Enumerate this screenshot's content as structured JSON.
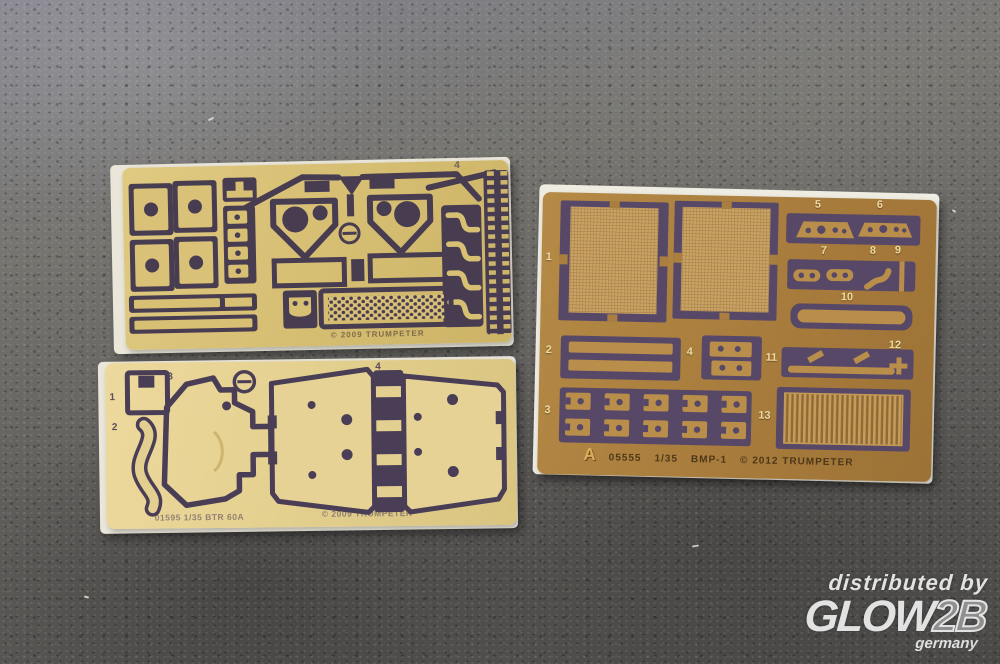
{
  "watermark": {
    "prefix": "distributed by",
    "brand_main": "GLOW",
    "brand_suffix": "2B",
    "country": "germany"
  },
  "sheets": {
    "top_left": {
      "part_labels": [
        "4"
      ],
      "footer_text": "© 2009 TRUMPETER"
    },
    "bottom_left": {
      "part_labels": [
        "1",
        "2",
        "3",
        "4"
      ],
      "footer_code": "01595 1/35 BTR 60A",
      "footer_copyright": "© 2009 TRUMPETER"
    },
    "right": {
      "part_labels": [
        "1",
        "2",
        "3",
        "4",
        "5",
        "6",
        "7",
        "8",
        "9",
        "10",
        "11",
        "12",
        "13"
      ],
      "footer": {
        "fret_letter": "A",
        "kit_number": "05555",
        "scale": "1/35",
        "kit_name": "BMP-1",
        "copyright": "© 2012 TRUMPETER"
      }
    }
  },
  "colors": {
    "carpet_gray": "#5e5d5a",
    "sheet_tan": "#d7bf74",
    "sheet_pale": "#e3cf90",
    "sheet_brown": "#a97e3e",
    "etch_dark": "#4a3e54",
    "backing_white": "#eae6da",
    "mesh_fill": "#c9a264",
    "label_cream": "#eeda9f",
    "watermark_gray": "#e2e2e2"
  }
}
